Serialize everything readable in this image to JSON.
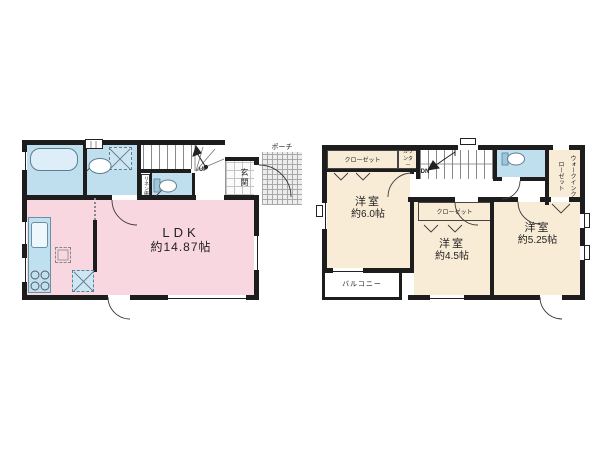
{
  "palette": {
    "wall": "#1d1d1d",
    "ldk_pink": "#f8d7e1",
    "wet_blue": "#bfdfee",
    "room_cream": "#f9ecd6",
    "fixture_line": "#5b7f93",
    "text": "#222222"
  },
  "floor1": {
    "ldk": {
      "name": "LDK",
      "area": "約14.87帖"
    },
    "genkan_label": "玄関",
    "porch_label": "ポーチ",
    "linen_label": "リネン庫",
    "stairs_label": "UP"
  },
  "floor2": {
    "bedroom1": {
      "name": "洋室",
      "area": "約6.0帖"
    },
    "bedroom2": {
      "name": "洋室",
      "area": "約4.5帖"
    },
    "bedroom3": {
      "name": "洋室",
      "area": "約5.25帖"
    },
    "closet_top_label": "クローゼット",
    "closet_mid_label": "クローゼット",
    "counter_label": "カウンター",
    "wic_label": "ウォークインクローゼット",
    "balcony_label": "バルコニー",
    "stairs_label": "DN"
  }
}
